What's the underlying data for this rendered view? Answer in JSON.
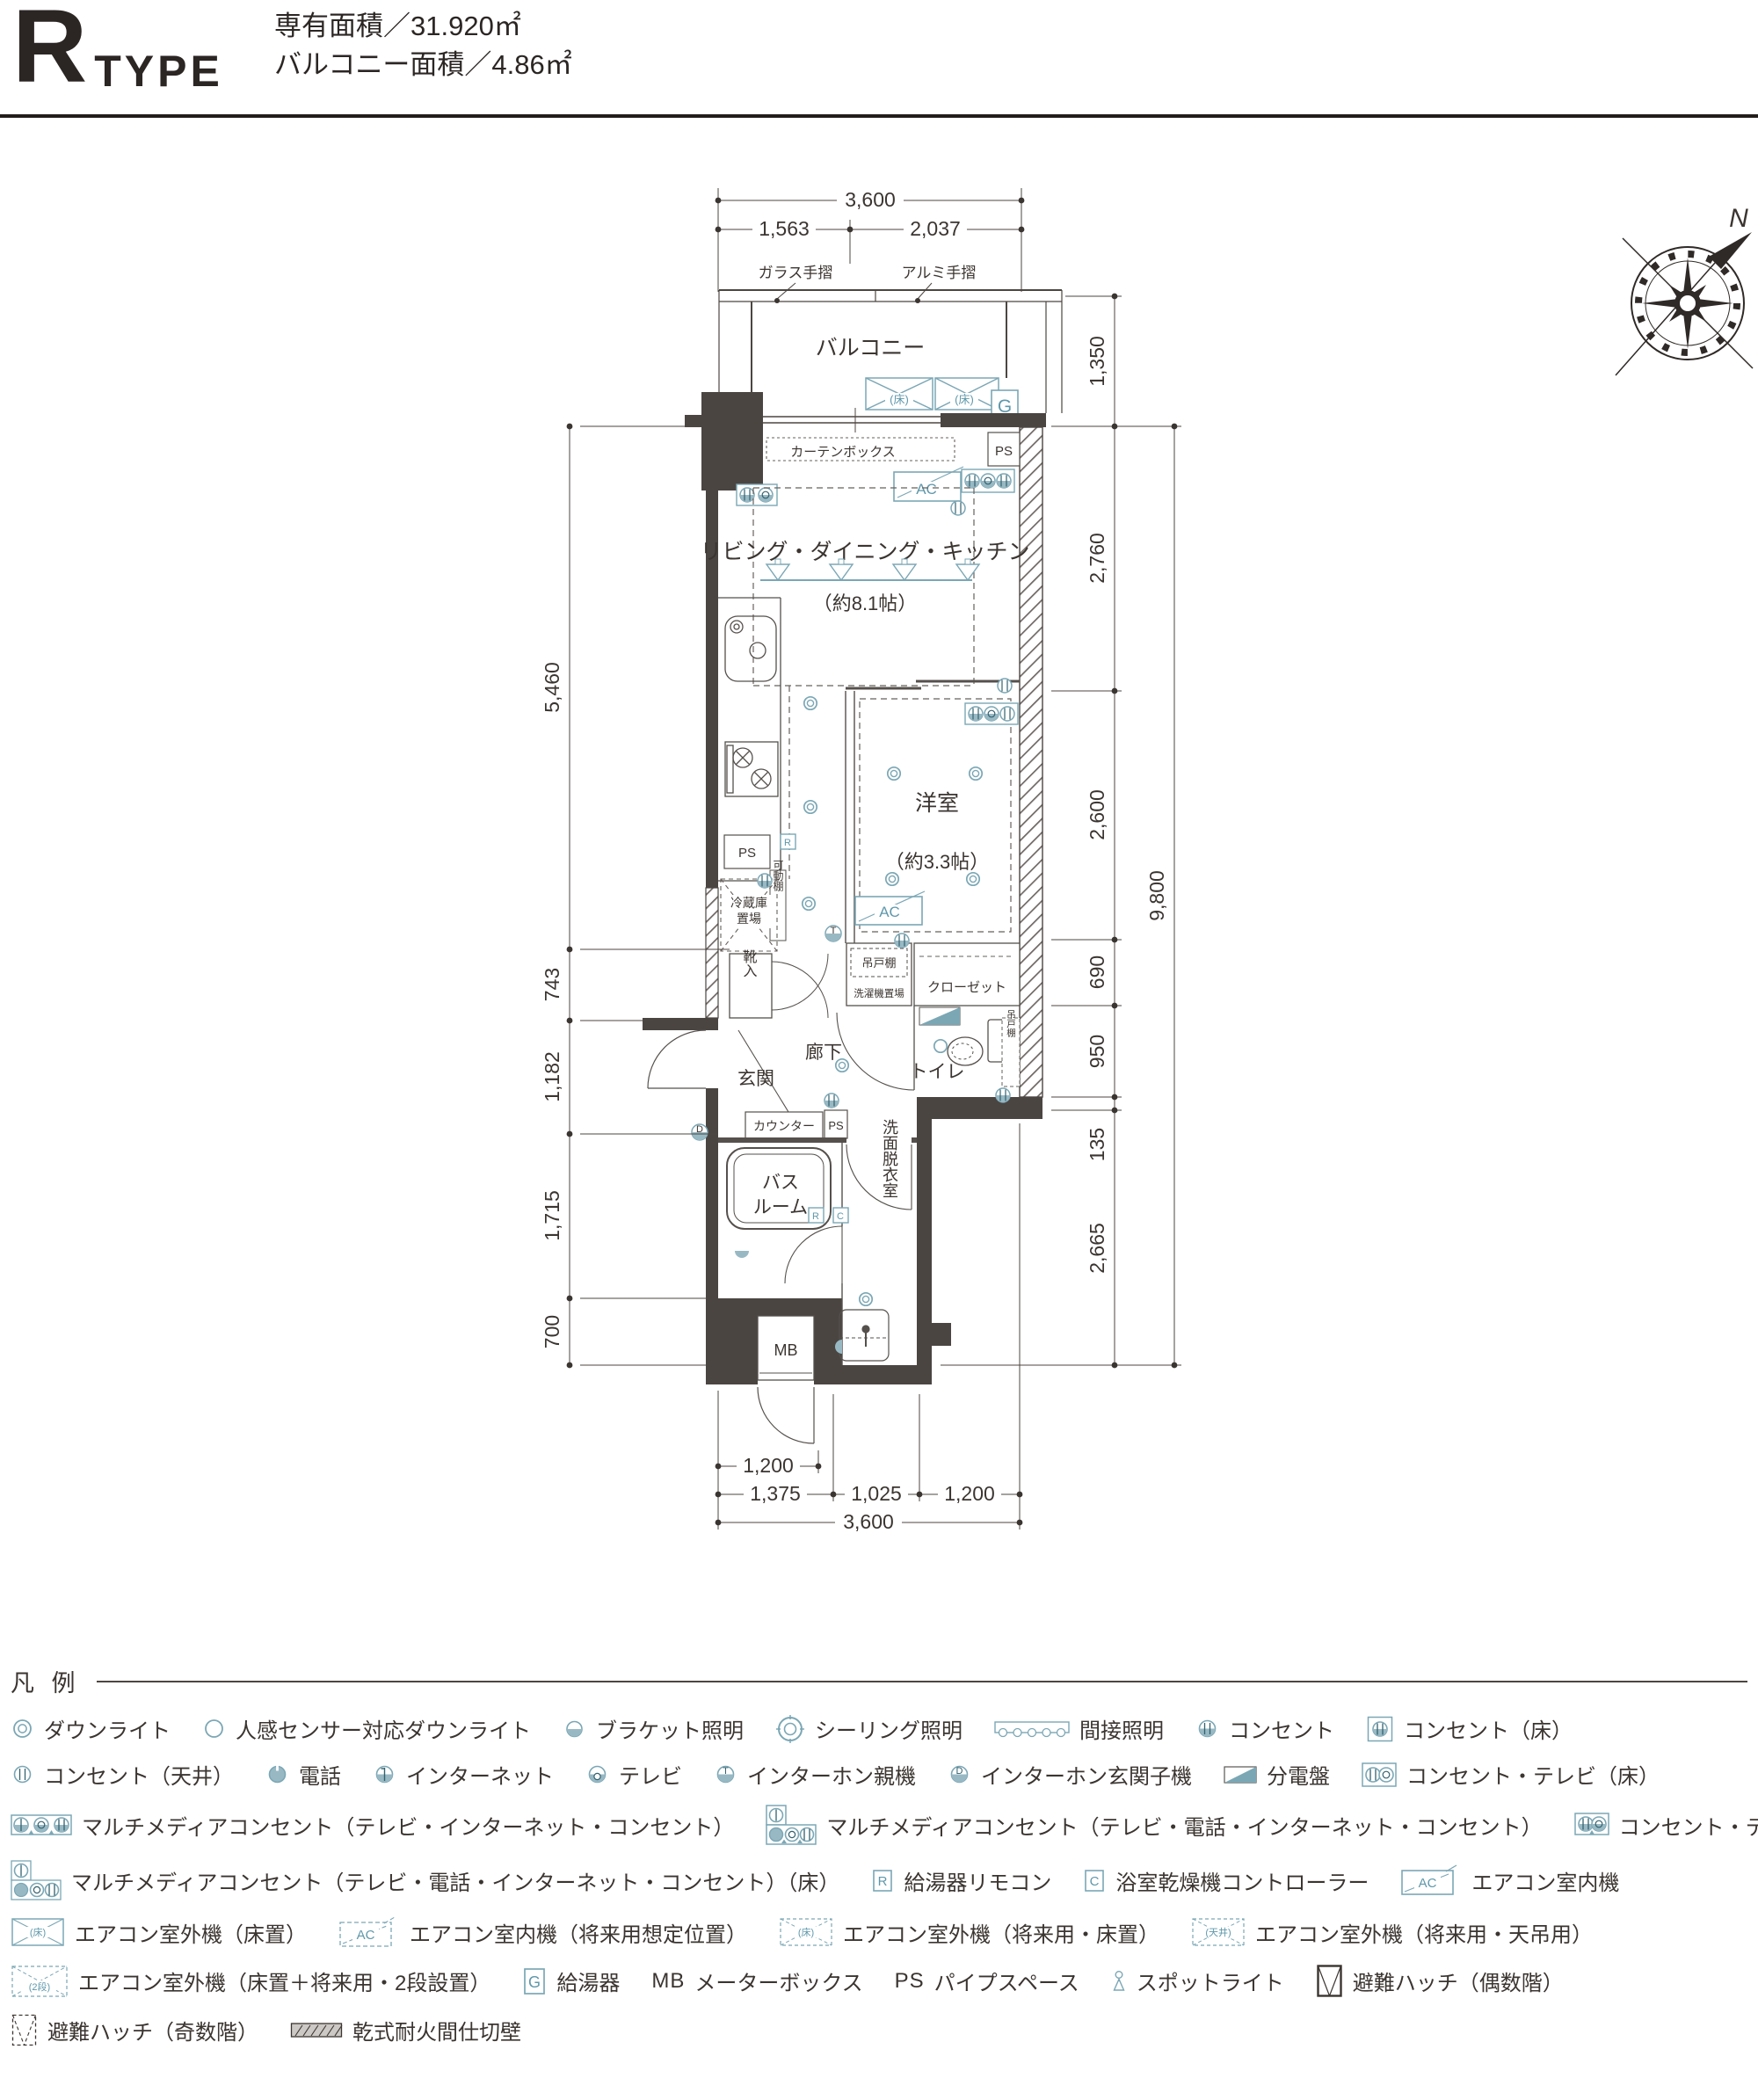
{
  "header": {
    "type_letter": "R",
    "type_word": "TYPE",
    "area_line1": "専有面積／31.920㎡",
    "area_line2": "バルコニー面積／4.86㎡"
  },
  "plan": {
    "labels": {
      "balcony": "バルコニー",
      "glass_rail": "ガラス手摺",
      "alumi_rail": "アルミ手摺",
      "curtain_box": "カーテンボックス",
      "ps_top": "PS",
      "ac1": "AC",
      "ac2": "AC",
      "g": "G",
      "floor1": "(床)",
      "floor2": "(床)",
      "ldk": "リビング・ダイニング・キッチン",
      "ldk_size": "（約8.1帖）",
      "western": "洋室",
      "western_size": "（約3.3帖）",
      "fridge_l1": "冷蔵庫",
      "fridge_l2": "置場",
      "movable_shelf": "可動棚",
      "ps_kitchen": "PS",
      "r_kitchen": "R",
      "t_mark": "T",
      "d_mark": "D",
      "shoe_box": "靴入",
      "entrance": "玄関",
      "corridor": "廊下",
      "toilet": "トイレ",
      "closet": "クローゼット",
      "hanging_shelf1": "吊戸棚",
      "washer": "洗濯機置場",
      "hanging_shelf2": "吊戸棚",
      "counter": "カウンター",
      "ps_counter": "PS",
      "bath_l1": "バス",
      "bath_l2": "ルーム",
      "washroom": "洗面脱衣室",
      "r_bath": "R",
      "c_bath": "C",
      "mb": "MB"
    },
    "dimensions": {
      "top_total": "3,600",
      "top_left": "1,563",
      "top_right": "2,037",
      "right_balcony": "1,350",
      "right_segs": [
        "2,760",
        "2,600",
        "690",
        "950",
        "135",
        "2,665"
      ],
      "right_total": "9,800",
      "left_segs": [
        "5,460",
        "743",
        "1,182",
        "1,715",
        "700"
      ],
      "bottom_door": "1,200",
      "bottom_segs": [
        "1,375",
        "1,025",
        "1,200"
      ],
      "bottom_total": "3,600"
    },
    "compass": "N"
  },
  "legend": {
    "title": "凡 例",
    "rows": [
      [
        {
          "icon": "downlight",
          "label": "ダウンライト"
        },
        {
          "icon": "sensor-downlight",
          "label": "人感センサー対応ダウンライト"
        },
        {
          "icon": "bracket-light",
          "label": "ブラケット照明"
        },
        {
          "icon": "ceiling-light",
          "label": "シーリング照明"
        },
        {
          "icon": "indirect-light",
          "label": "間接照明"
        },
        {
          "icon": "outlet",
          "label": "コンセント"
        },
        {
          "icon": "outlet-floor",
          "label": "コンセント（床）"
        }
      ],
      [
        {
          "icon": "outlet-ceiling",
          "label": "コンセント（天井）"
        },
        {
          "icon": "phone",
          "label": "電話"
        },
        {
          "icon": "internet",
          "label": "インターネット"
        },
        {
          "icon": "tv",
          "label": "テレビ"
        },
        {
          "icon": "intercom",
          "marker": "T",
          "label": "インターホン親機"
        },
        {
          "icon": "intercom",
          "marker": "D",
          "label": "インターホン玄関子機"
        },
        {
          "icon": "distribution-board",
          "label": "分電盤"
        },
        {
          "icon": "outlet-tv-floor",
          "label": "コンセント・テレビ（床）"
        }
      ],
      [
        {
          "icon": "multimedia-3",
          "label": "マルチメディアコンセント（テレビ・インターネット・コンセント）"
        },
        {
          "icon": "multimedia-4",
          "label": "マルチメディアコンセント（テレビ・電話・インターネット・コンセント）"
        },
        {
          "icon": "outlet-tv",
          "label": "コンセント・テレビ"
        }
      ],
      [
        {
          "icon": "multimedia-4-floor",
          "label": "マルチメディアコンセント（テレビ・電話・インターネット・コンセント）（床）"
        },
        {
          "icon": "letter-box",
          "marker": "R",
          "label": "給湯器リモコン"
        },
        {
          "icon": "letter-box",
          "marker": "C",
          "label": "浴室乾燥機コントローラー"
        },
        {
          "icon": "ac-indoor",
          "marker": "AC",
          "label": "エアコン室内機"
        }
      ],
      [
        {
          "icon": "ac-outdoor-floor",
          "marker": "(床)",
          "label": "エアコン室外機（床置）"
        },
        {
          "icon": "ac-indoor-future",
          "marker": "AC",
          "label": "エアコン室内機（将来用想定位置）"
        },
        {
          "icon": "ac-outdoor-future-floor",
          "marker": "(床)",
          "label": "エアコン室外機（将来用・床置）"
        },
        {
          "icon": "ac-outdoor-future-ceiling",
          "marker": "(天井)",
          "label": "エアコン室外機（将来用・天吊用）"
        }
      ],
      [
        {
          "icon": "ac-outdoor-2dan",
          "marker": "(2段)",
          "label": "エアコン室外機（床置＋将来用・2段設置）"
        },
        {
          "icon": "letter-box-lg",
          "marker": "G",
          "label": "給湯器"
        },
        {
          "icon": "mb-text",
          "marker": "MB",
          "label": "メーターボックス"
        },
        {
          "icon": "ps-text",
          "marker": "PS",
          "label": "パイプスペース"
        },
        {
          "icon": "spotlight",
          "label": "スポットライト"
        },
        {
          "icon": "hatch-even",
          "label": "避難ハッチ（偶数階）"
        }
      ],
      [
        {
          "icon": "hatch-odd",
          "label": "避難ハッチ（奇数階）"
        },
        {
          "icon": "firewall",
          "label": "乾式耐火間仕切壁"
        }
      ]
    ]
  }
}
